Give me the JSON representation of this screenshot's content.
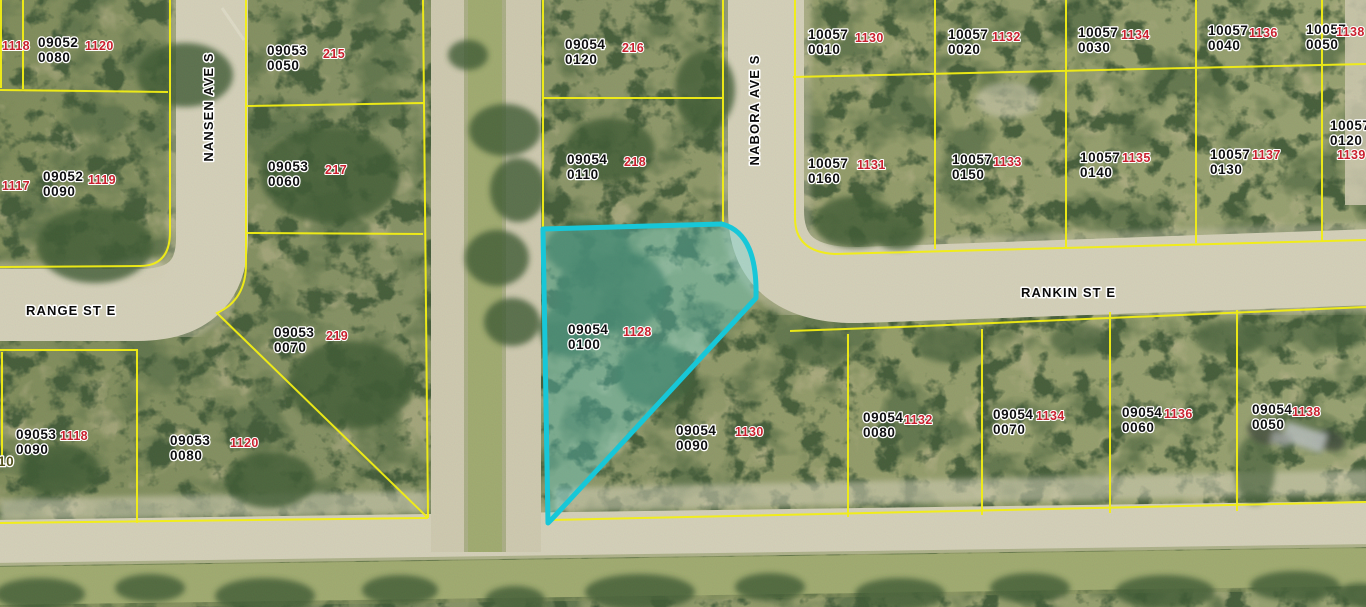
{
  "map": {
    "colors": {
      "parcel_line": "#f2ee14",
      "highlight_outline": "#17c7d8",
      "highlight_fill": "rgba(90,215,220,0.32)",
      "label_text": "#0e0e10",
      "number_text": "#c9202e"
    },
    "highlight": {
      "id1": "09054",
      "id2": "0100",
      "num": "1128"
    },
    "parcels": [
      {
        "id1": "09052",
        "id2": "0080",
        "num": "1120",
        "x": 38,
        "y": 47,
        "nx": 85,
        "ny": 50
      },
      {
        "id1": "09053",
        "id2": "0050",
        "num": "215",
        "x": 267,
        "y": 55,
        "nx": 323,
        "ny": 58
      },
      {
        "id1": "09052",
        "id2": "0090",
        "num": "1119",
        "x": 43,
        "y": 181,
        "nx": 88,
        "ny": 184
      },
      {
        "id1": "09053",
        "id2": "0060",
        "num": "217",
        "x": 268,
        "y": 171,
        "nx": 325,
        "ny": 174
      },
      {
        "id1": "09054",
        "id2": "0120",
        "num": "216",
        "x": 565,
        "y": 49,
        "nx": 622,
        "ny": 52
      },
      {
        "id1": "09054",
        "id2": "0110",
        "num": "218",
        "x": 567,
        "y": 164,
        "nx": 624,
        "ny": 166
      },
      {
        "id1": "10057",
        "id2": "0010",
        "num": "1130",
        "x": 808,
        "y": 39,
        "nx": 855,
        "ny": 42
      },
      {
        "id1": "10057",
        "id2": "0020",
        "num": "1132",
        "x": 948,
        "y": 39,
        "nx": 992,
        "ny": 41
      },
      {
        "id1": "10057",
        "id2": "0030",
        "num": "1134",
        "x": 1078,
        "y": 37,
        "nx": 1121,
        "ny": 39
      },
      {
        "id1": "10057",
        "id2": "0040",
        "num": "1136",
        "x": 1208,
        "y": 35,
        "nx": 1249,
        "ny": 37
      },
      {
        "id1": "10057",
        "id2": "0050",
        "num": "1138",
        "x": 1306,
        "y": 34,
        "nx": 1336,
        "ny": 36
      },
      {
        "id1": "10057",
        "id2": "0160",
        "num": "1131",
        "x": 808,
        "y": 168,
        "nx": 857,
        "ny": 169
      },
      {
        "id1": "10057",
        "id2": "0150",
        "num": "1133",
        "x": 952,
        "y": 164,
        "nx": 993,
        "ny": 166
      },
      {
        "id1": "10057",
        "id2": "0140",
        "num": "1135",
        "x": 1080,
        "y": 162,
        "nx": 1122,
        "ny": 162
      },
      {
        "id1": "10057",
        "id2": "0130",
        "num": "1137",
        "x": 1210,
        "y": 159,
        "nx": 1252,
        "ny": 159
      },
      {
        "id1": "10057",
        "id2": "0120",
        "num": "1139",
        "x": 1330,
        "y": 130,
        "nx": 1337,
        "ny": 159
      },
      {
        "id1": "09053",
        "id2": "0070",
        "num": "219",
        "x": 274,
        "y": 337,
        "nx": 326,
        "ny": 340
      },
      {
        "id1": "09054",
        "id2": "0100",
        "num": "1128",
        "x": 568,
        "y": 334,
        "nx": 623,
        "ny": 336,
        "highlighted": true
      },
      {
        "id1": "09054",
        "id2": "0090",
        "num": "1130",
        "x": 676,
        "y": 435,
        "nx": 735,
        "ny": 436
      },
      {
        "id1": "09053",
        "id2": "0090",
        "num": "1118",
        "x": 16,
        "y": 439,
        "nx": 60,
        "ny": 440
      },
      {
        "id1": "09053",
        "id2": "0080",
        "num": "1120",
        "x": 170,
        "y": 445,
        "nx": 230,
        "ny": 447
      },
      {
        "id1": "09054",
        "id2": "0080",
        "num": "1132",
        "x": 863,
        "y": 422,
        "nx": 904,
        "ny": 424
      },
      {
        "id1": "09054",
        "id2": "0070",
        "num": "1134",
        "x": 993,
        "y": 419,
        "nx": 1036,
        "ny": 420
      },
      {
        "id1": "09054",
        "id2": "0060",
        "num": "1136",
        "x": 1122,
        "y": 417,
        "nx": 1164,
        "ny": 418
      },
      {
        "id1": "09054",
        "id2": "0050",
        "num": "1138",
        "x": 1252,
        "y": 414,
        "nx": 1292,
        "ny": 416
      }
    ],
    "edge_numbers": [
      {
        "text": "1118",
        "x": 2,
        "y": 50
      },
      {
        "text": "1117",
        "x": 2,
        "y": 190
      }
    ],
    "edge_partial": {
      "text": "10",
      "x": -2,
      "y": 466
    },
    "streets": [
      {
        "name": "NANSEN AVE S",
        "x": 213,
        "y": 107,
        "rotate": -90
      },
      {
        "name": "NABORA AVE S",
        "x": 759,
        "y": 110,
        "rotate": -90
      },
      {
        "name": "RANGE ST E",
        "x": 26,
        "y": 315,
        "rotate": 0
      },
      {
        "name": "RANKIN ST E",
        "x": 1021,
        "y": 297,
        "rotate": 0
      }
    ]
  }
}
